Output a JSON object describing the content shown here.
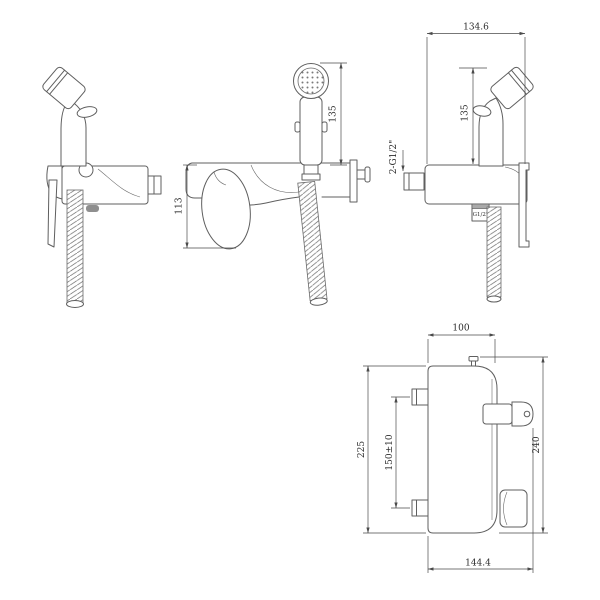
{
  "drawing": {
    "type": "technical-dimension-drawing",
    "subject": "wall-mounted bidet hand sprayer mixer, four orthographic views",
    "colors": {
      "line": "#5f5f5f",
      "dimension_line": "#4a4a4a",
      "text": "#2b2b2b",
      "slot_fill": "#8f8f8f",
      "background": "#ffffff"
    }
  },
  "labels": {
    "front": {
      "handle_height": "113",
      "sprayer_height": "135"
    },
    "rear": {
      "width": "134.6",
      "sprayer_height": "135",
      "inlet_thread": "2-G1/2\"",
      "hose_thread": "G1/2\""
    },
    "plan": {
      "top_width": "100",
      "mount_spacing": "150±10",
      "plate_height": "225",
      "overall_height": "240",
      "overall_width": "144.4"
    }
  }
}
